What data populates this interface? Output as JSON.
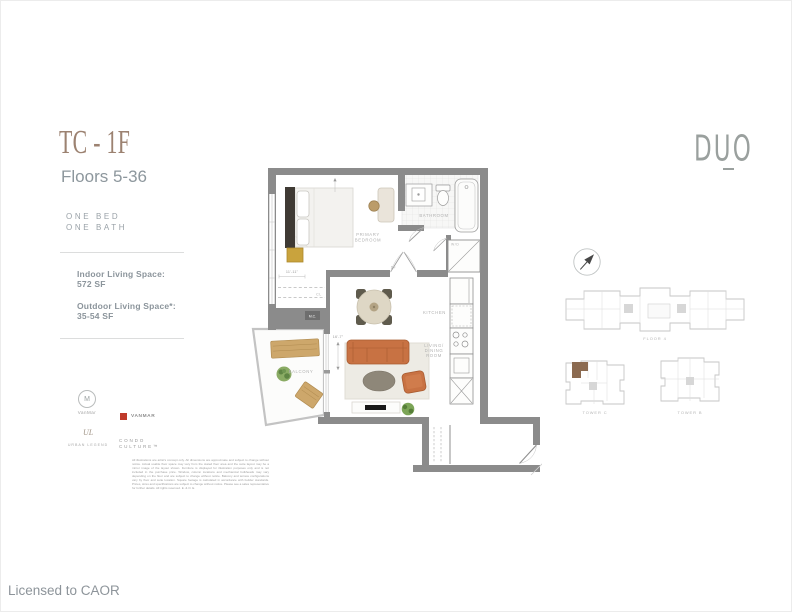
{
  "unit": {
    "code": "TC - 1F",
    "floors": "Floors 5-36",
    "bed_line": "ONE BED",
    "bath_line": "ONE BATH",
    "indoor_label": "Indoor Living Space:",
    "indoor_value": "572 SF",
    "outdoor_label": "Outdoor Living Space*:",
    "outdoor_value": "35-54 SF"
  },
  "brand": {
    "name": "DUO"
  },
  "plan_labels": {
    "primary_bedroom_1": "PRIMARY",
    "primary_bedroom_2": "BEDROOM",
    "bathroom": "BATHROOM",
    "wd": "W/D",
    "kitchen": "KITCHEN",
    "living_1": "LIVING/",
    "living_2": "DINING",
    "living_3": "ROOM",
    "balcony": "BALCONY",
    "closet": "CL",
    "mech": "M.C.",
    "door": "DF",
    "dim_bedroom": "11'-11\"",
    "dim_living": "16'-7\""
  },
  "keyplan": {
    "floor_label": "FLOOR 4",
    "tower_left": "TOWER C",
    "tower_right": "TOWER B"
  },
  "partners": {
    "p1_mark": "M",
    "p1_name": "VanMar",
    "p2_name": "VANMAR",
    "p3_mark": "UL",
    "p3_name": "URBAN LEGEND",
    "p4_line1": "CONDO",
    "p4_line2": "CULTURE™"
  },
  "disclaimer": "All illustrations are artist's concept only. All dimensions are approximate and subject to change without notice. Actual usable floor space may vary from the stated floor area and the suite layout may be a mirror image of the layout shown. Furniture is displayed for illustration purposes only and is not included in the purchase price. Window, column locations and mechanical bulkheads may vary depending on the floor and are subject to change without notice. Balcony and terrace configurations vary by floor and suite location. Square footage is calculated in accordance with builder standards. Prices, sizes and specifications are subject to change without notice. Please see a sales representative for further details. All rights reserved. E. & O. E.",
  "footer": "Licensed to CAOR",
  "colors": {
    "accent_brown": "#9c8271",
    "text_gray": "#8d979d",
    "wall_gray": "#8b8b8b",
    "sofa_orange": "#c87243",
    "highlight_unit": "#8b6a50",
    "partner_red": "#bf3a2b"
  }
}
